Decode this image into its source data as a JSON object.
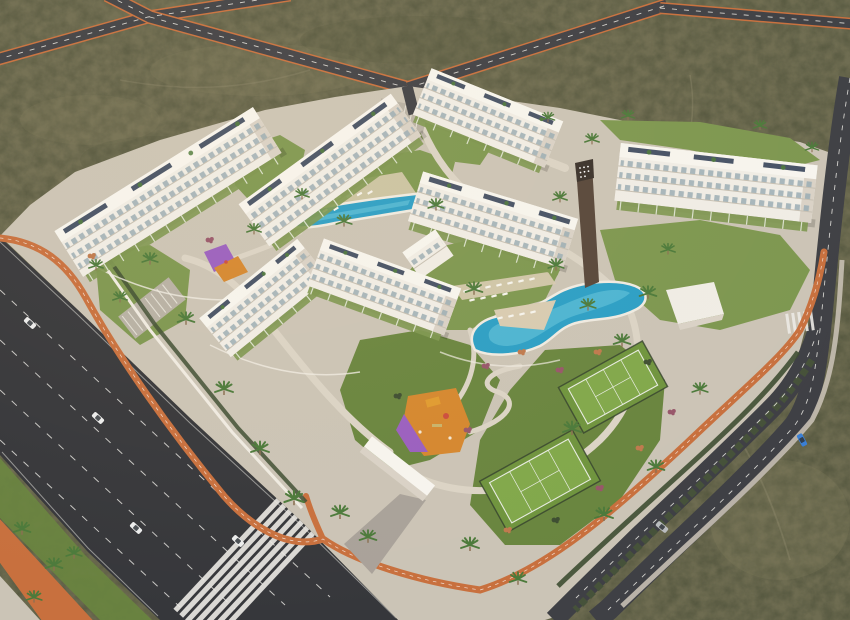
{
  "scene": {
    "type": "3D architectural aerial render",
    "subject": "Gated residential apartment complex with pools, sport courts and landscaped gardens",
    "environment": "Semi-arid olive scrubland crossed by new perimeter roads",
    "lighting": "Warm late-afternoon sunlight",
    "visible_text": "none"
  },
  "palette": {
    "asphalt": "#3f4045",
    "asphaltDark": "#36373b",
    "laneWhite": "#e2e1dd",
    "bikeOrange": "#c8703e",
    "sidewalk": "#c6bfb2",
    "plaza": "#cbc4b6",
    "pathLight": "#dbd4c6",
    "wallWhite": "#efebe2",
    "scrub": "#6e6c51",
    "scrubDark": "#4a4f37",
    "scrubLight": "#8b8566",
    "trail": "#9c9476",
    "lawn": "#7d9750",
    "lawnDark": "#69853f",
    "hedge": "#3e4e32",
    "treeGreen": "#4c7a3b",
    "trunk": "#8a6f52",
    "flowerPink": "#97566a",
    "flowerOrange": "#bf7a4e",
    "building": "#f0ede6",
    "buildingShade": "#d9d2c7",
    "roof": "#f7f5ef",
    "slab": "#c6bfb2",
    "window": "#9aacb4",
    "solar": "#36435a",
    "poolBlue": "#2b9fc6",
    "poolLight": "#7fd6e6",
    "deck": "#d8cbb2",
    "court": "#6f943e",
    "courtLight": "#81a84b",
    "courtLine": "#e8ece2",
    "fence": "#33402d",
    "playOrange": "#d5872f",
    "playPurple": "#9a5fc0",
    "carWhite": "#eceded",
    "carSilver": "#b9bcbe",
    "carBlue": "#3a7fd4",
    "carGlass": "#2e3338",
    "median": "#46523a",
    "totem": "#57473b",
    "totemDark": "#3a322c",
    "shadow": "rgba(0,0,0,0.16)"
  },
  "features": {
    "apartment_blocks": [
      "block-a-northwest",
      "block-b-north",
      "block-c-north",
      "block-c-south",
      "block-d-east",
      "block-e-west-wing",
      "block-e-east-wing"
    ],
    "amenities": [
      "upper-lap-pool",
      "main-lagoon-pool",
      "sun-decks-with-loungers",
      "tennis-court-upper",
      "tennis-court-lower",
      "playground-main",
      "playground-small",
      "landscaped-gardens",
      "palm-lined-paths",
      "brand-totem-sign"
    ],
    "infrastructure": [
      "northwest-road",
      "north-access-road",
      "northeast-road",
      "east-road",
      "southeast-dual-carriageway",
      "southwest-avenue",
      "orange-cycle-lane",
      "pedestrian-crossings",
      "south-entrance-canopy",
      "north-entrance-parking",
      "west-parking-bays"
    ]
  },
  "counts": {
    "apartment_blocks": 6,
    "swimming_pools": 2,
    "sport_courts": 2,
    "playgrounds": 2,
    "cars": 6,
    "crosswalks": 2,
    "road_intersections": 3
  }
}
